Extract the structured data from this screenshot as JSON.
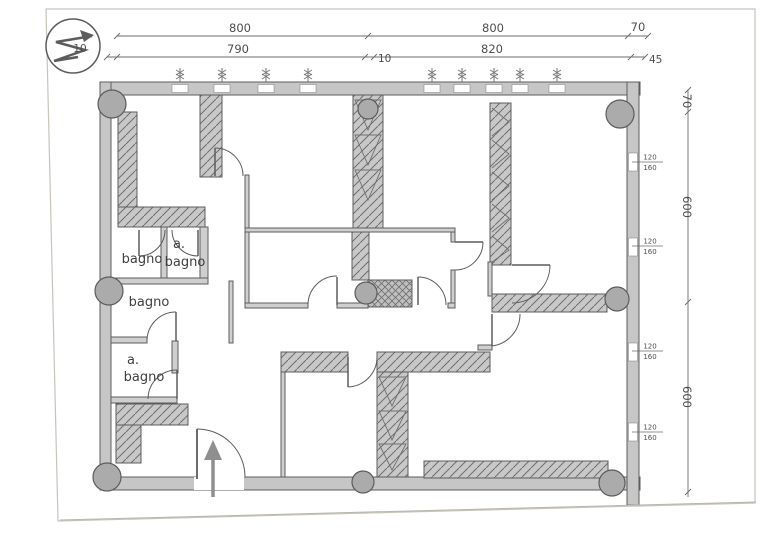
{
  "title": "floor-plan-drawing",
  "colors": {
    "paper": "#ffffff",
    "line": "#5c5c5c",
    "wall_fill": "#c6c6c6",
    "column_fill": "#ababab",
    "hatch_line": "#6f6f6f",
    "frame": "#c8c3bc",
    "arrow": "#8f8f8f"
  },
  "icons": {
    "north_arrow": "north-arrow",
    "window_tick": "window-dimension-tick",
    "entrance_arrow": "entrance-arrow"
  },
  "dimensions": {
    "top_row1": [
      "800",
      "800",
      "70"
    ],
    "top_row2": [
      "10",
      "790",
      "10",
      "820",
      "45"
    ],
    "right_col": [
      "70",
      "600",
      "600"
    ]
  },
  "windows": [
    {
      "top": "120",
      "bottom": "160"
    },
    {
      "top": "120",
      "bottom": "160"
    },
    {
      "top": "120",
      "bottom": "160"
    },
    {
      "top": "120",
      "bottom": "160"
    }
  ],
  "rooms": {
    "bagno_top": "bagno",
    "abagno_top": {
      "l1": "a.",
      "l2": "bagno"
    },
    "bagno_mid": "bagno",
    "abagno_bottom": {
      "l1": "a.",
      "l2": "bagno"
    }
  }
}
